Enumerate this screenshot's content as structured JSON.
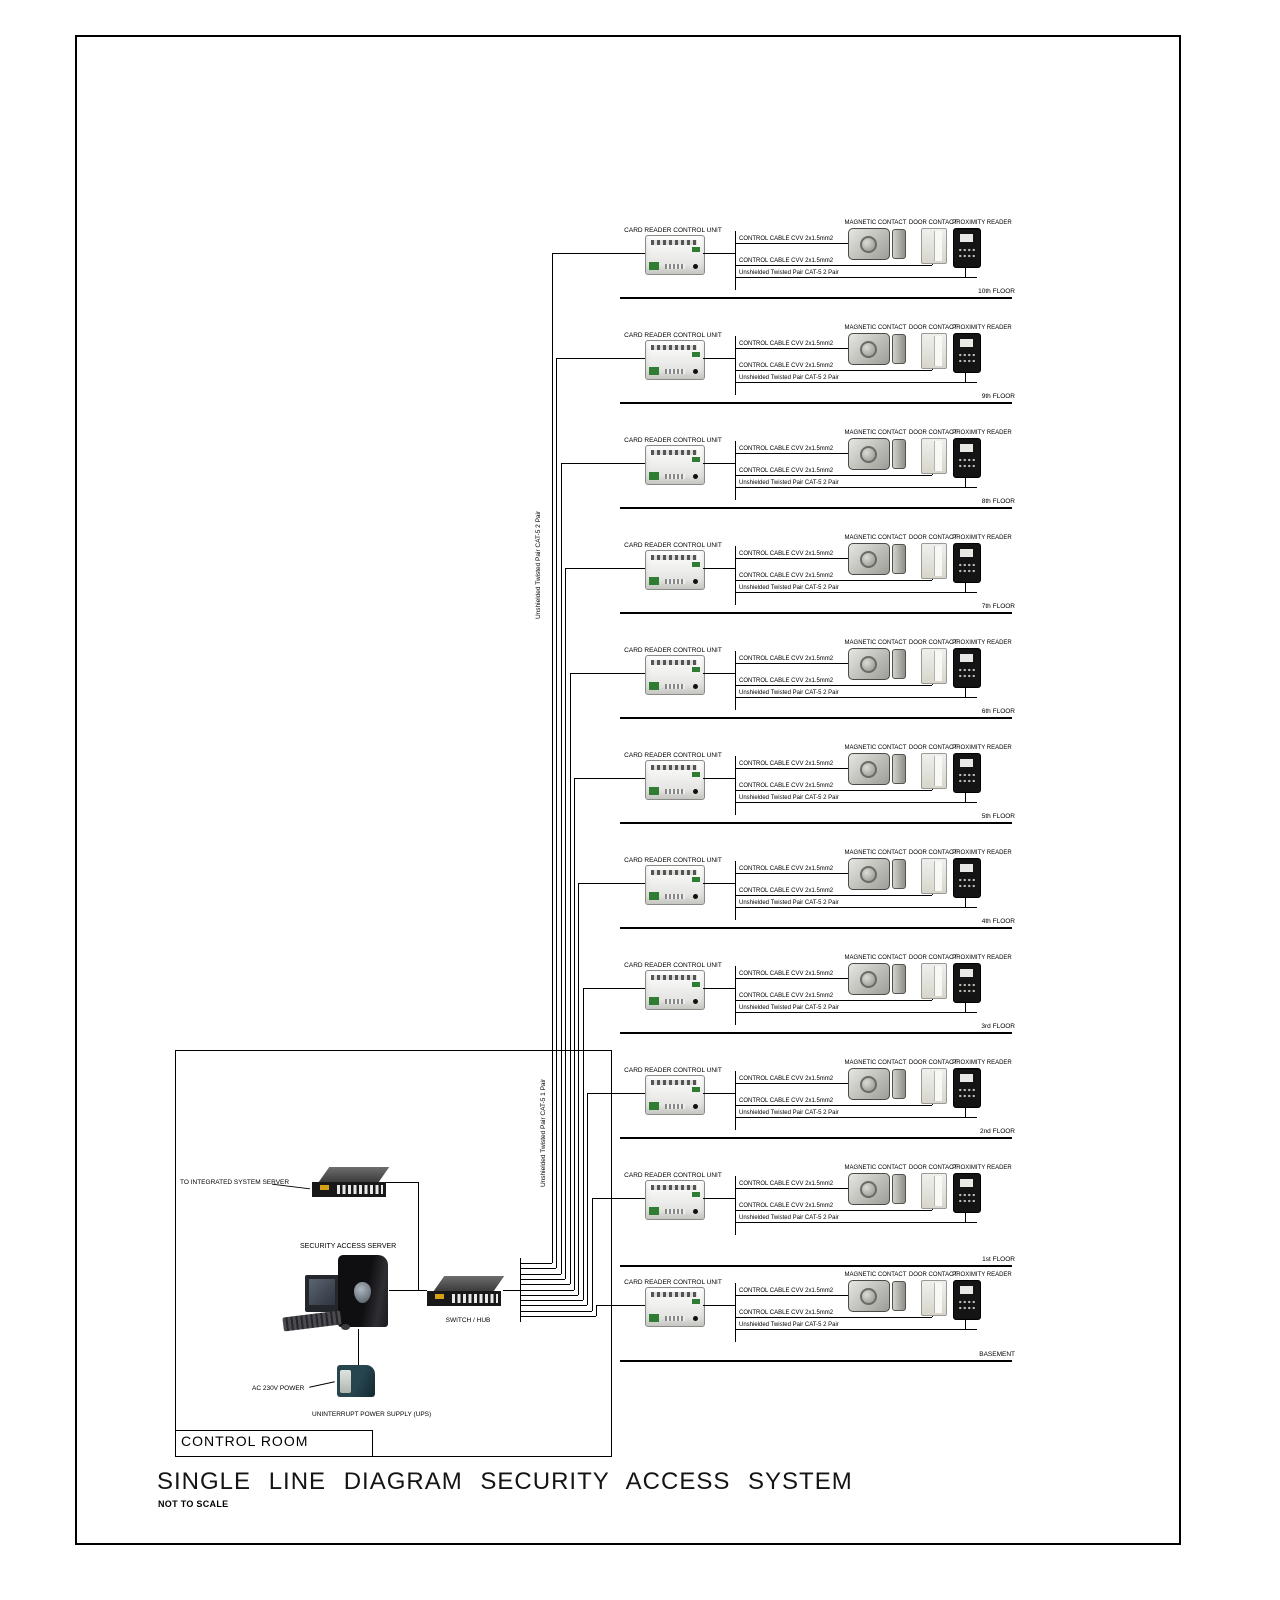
{
  "title": "SINGLE LINE DIAGRAM SECURITY ACCESS SYSTEM",
  "subtitle": "NOT TO SCALE",
  "control_room": {
    "label": "CONTROL ROOM",
    "integrated_server_label": "TO INTEGRATED SYSTEM SERVER",
    "security_access_server_label": "SECURITY ACCESS SERVER",
    "switch_hub_label": "SWITCH / HUB",
    "ac_power_label": "AC 230V POWER",
    "ups_label": "UNINTERRUPT POWER SUPPLY (UPS)"
  },
  "riser": {
    "label_upper": "Unshielded Twisted Pair CAT-5  2 Pair",
    "label_lower": "Unshielded Twisted Pair CAT-5  1 Pair"
  },
  "row_labels": {
    "controller": "CARD READER CONTROL UNIT",
    "magnetic_contact": "MAGNETIC CONTACT",
    "door_contact": "DOOR CONTACT",
    "proximity_reader": "PROXIMITY READER",
    "cable1": "CONTROL CABLE CVV 2x1.5mm2",
    "cable2": "CONTROL CABLE CVV 2x1.5mm2",
    "cable3": "Unshielded Twisted Pair CAT-5  2 Pair"
  },
  "floors": [
    {
      "name": "10th FLOOR"
    },
    {
      "name": "9th FLOOR"
    },
    {
      "name": "8th FLOOR"
    },
    {
      "name": "7th FLOOR"
    },
    {
      "name": "6th FLOOR"
    },
    {
      "name": "5th FLOOR"
    },
    {
      "name": "4th FLOOR"
    },
    {
      "name": "3rd FLOOR"
    },
    {
      "name": "2nd FLOOR"
    },
    {
      "name": "1st FLOOR"
    },
    {
      "name": "BASEMENT"
    }
  ]
}
